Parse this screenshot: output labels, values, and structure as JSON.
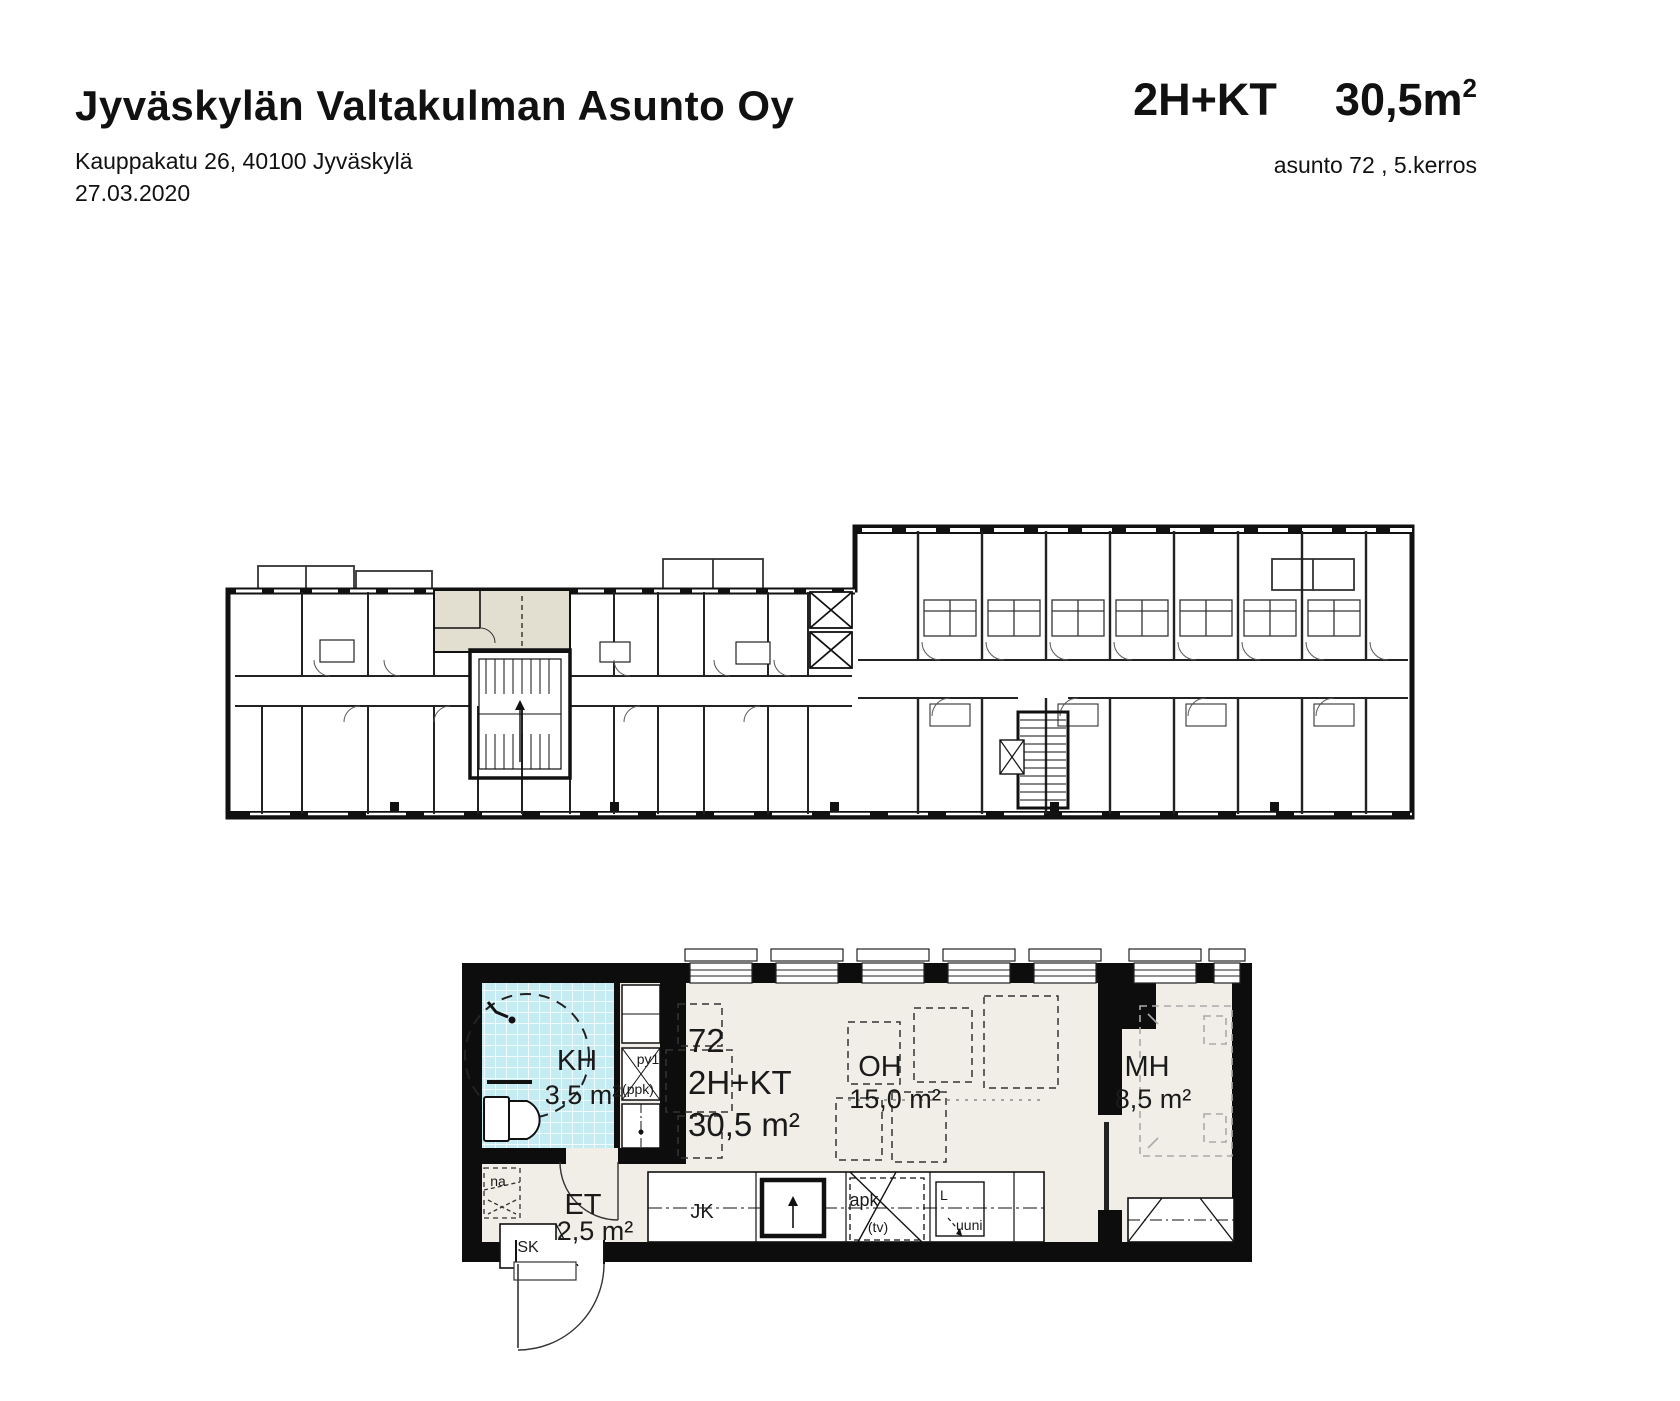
{
  "header": {
    "title": "Jyväskylän Valtakulman Asunto Oy",
    "address": "Kauppakatu 26, 40100 Jyväskylä",
    "date": "27.03.2020",
    "unit_type": "2H+KT",
    "unit_area": "30,5m",
    "unit_area_sup": "2",
    "unit_info": "asunto 72 , 5.kerros"
  },
  "overview_plan": {
    "highlight_color": "#e3dfd0"
  },
  "detail_plan": {
    "apartment_number": "72",
    "apartment_type": "2H+KT",
    "apartment_area": "30,5 m²",
    "rooms": {
      "kh": {
        "label": "KH",
        "area": "3,5 m²"
      },
      "et": {
        "label": "ET",
        "area": "2,5 m²"
      },
      "oh": {
        "label": "OH",
        "area": "15,0 m²"
      },
      "mh": {
        "label": "MH",
        "area": "8,5 m²"
      }
    },
    "labels": {
      "sk": "SK",
      "na": "na",
      "py1": "py1",
      "ppk": "(ppk)",
      "jk": "JK",
      "apk": "apk",
      "apk_note": "(tv)",
      "stove": "L",
      "oven": "uuni"
    },
    "colors": {
      "bathroom": "#c6ecf3",
      "floor": "#f0eee6"
    }
  }
}
